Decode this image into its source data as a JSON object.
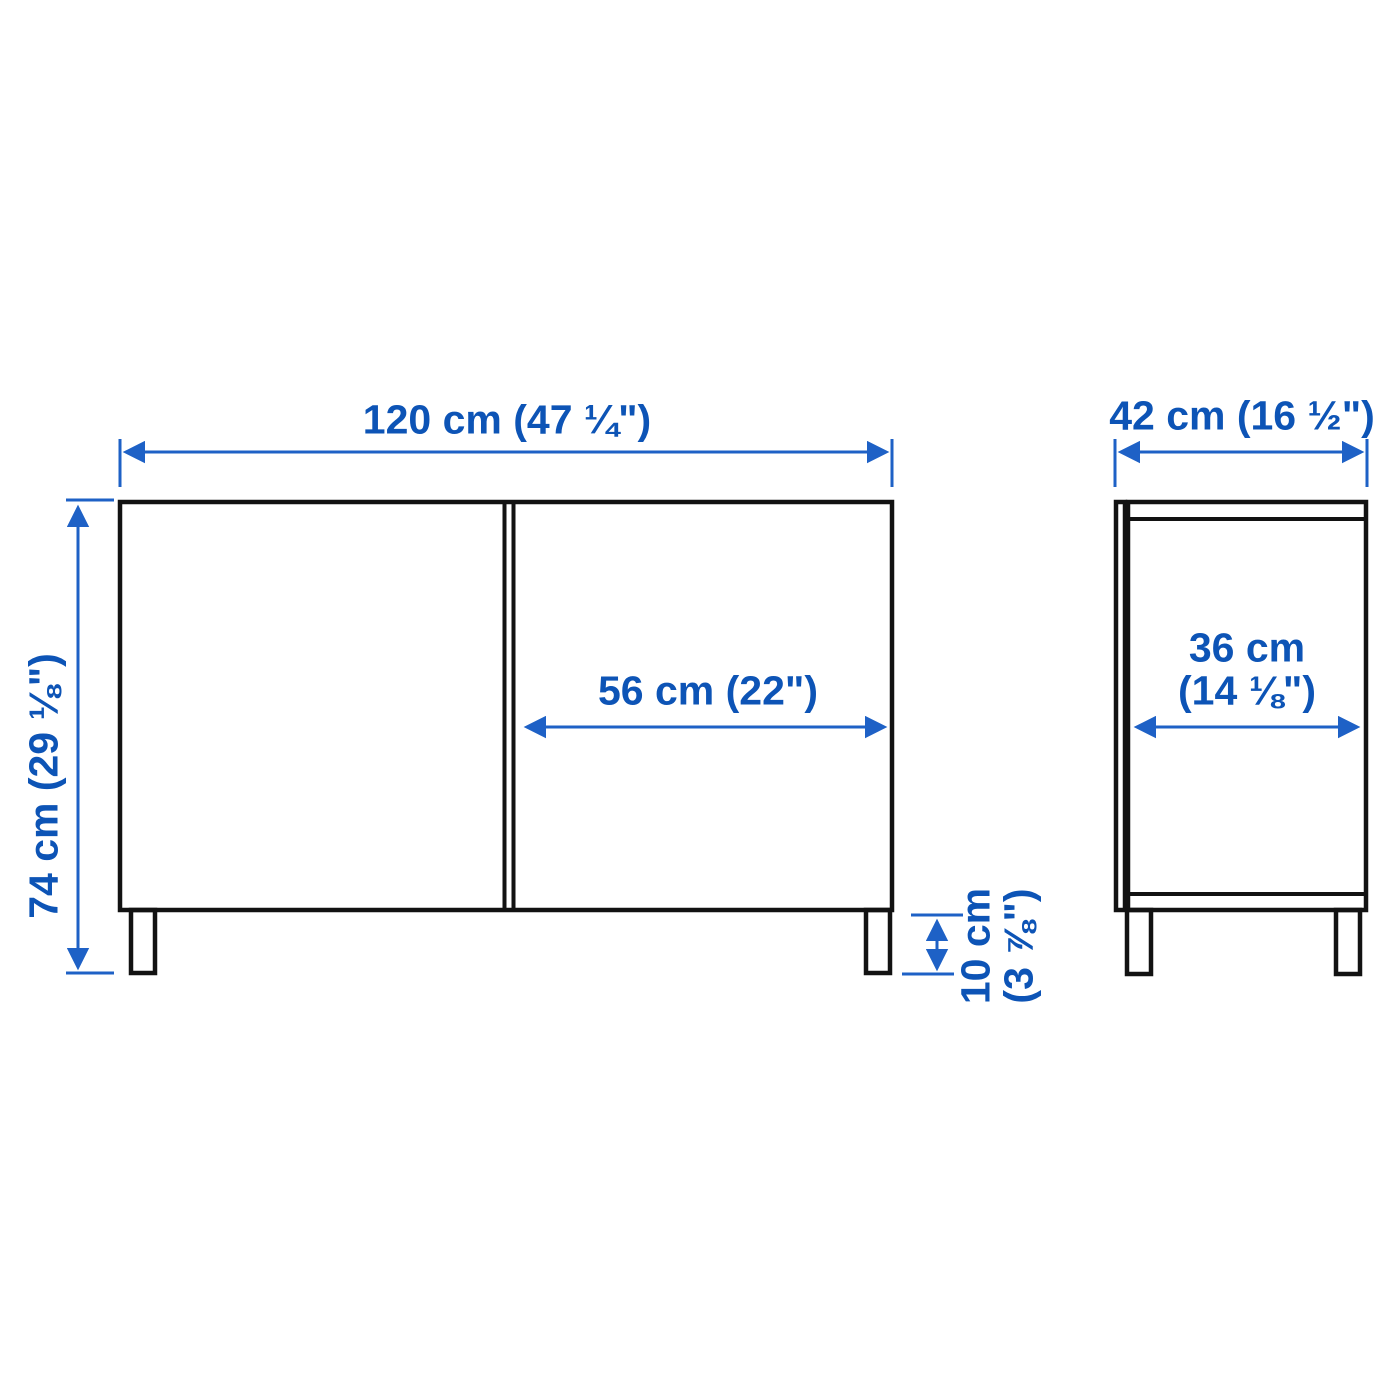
{
  "diagram": {
    "product_type": "two-door cabinet dimension drawing",
    "colors": {
      "dimension_text_blue": "#0d54b6",
      "dimension_line_blue": "#1e61c6",
      "outline_black": "#121212",
      "background": "#ffffff"
    },
    "front_view": {
      "width_label": "120 cm (47 ¼\")",
      "height_label": "74 cm (29 ⅛\")",
      "door_width_label": "56 cm (22\")",
      "leg_height_label": [
        "10 cm",
        "(3 ⅞\")"
      ]
    },
    "side_view": {
      "depth_label": "42 cm (16 ½\")",
      "inner_depth_label": [
        "36 cm",
        "(14 ⅛\")"
      ]
    }
  }
}
